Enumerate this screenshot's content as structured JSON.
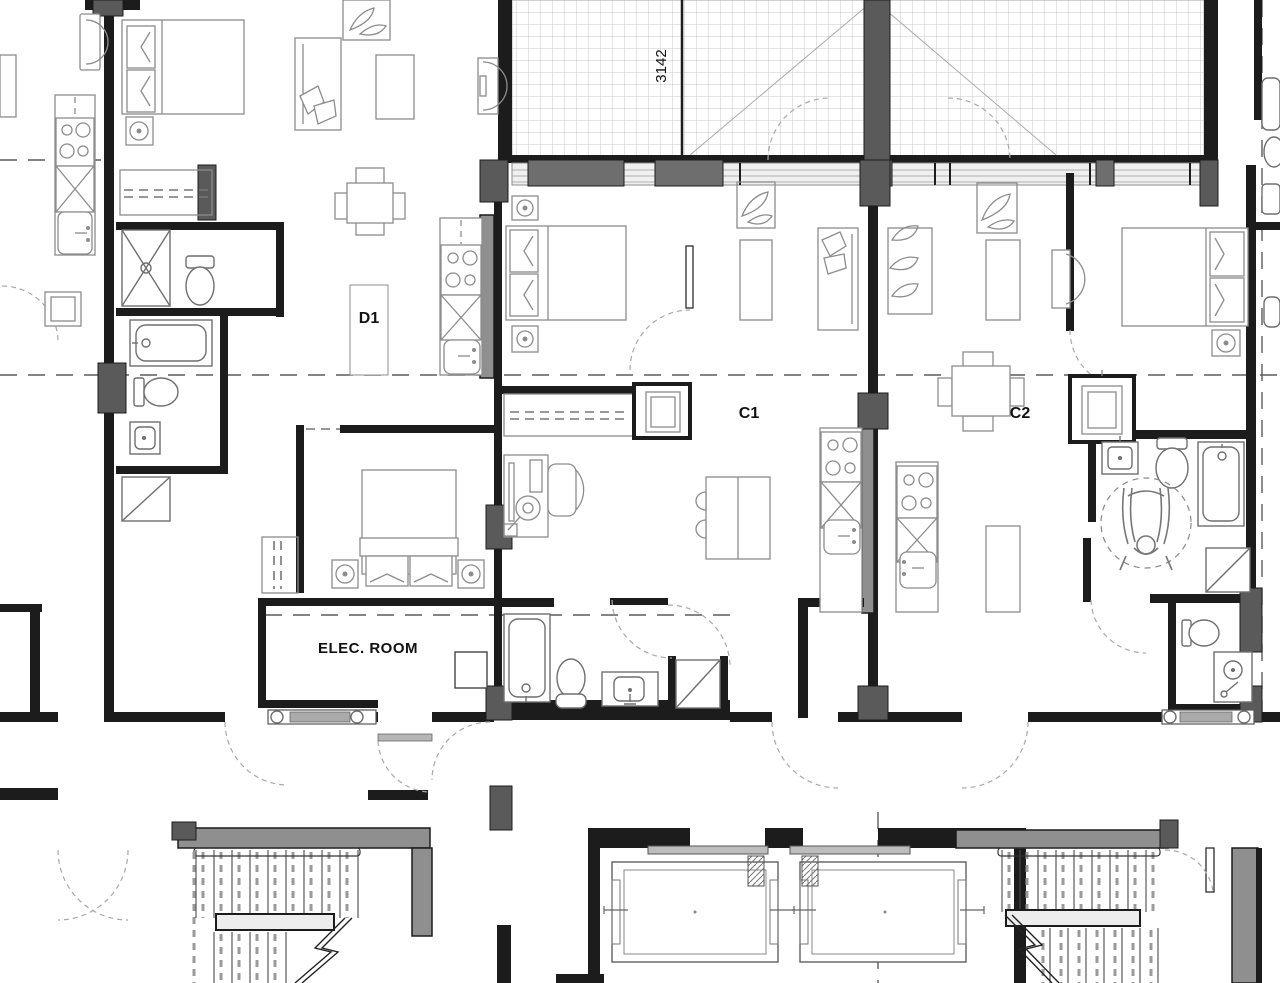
{
  "drawing": {
    "type": "architectural floor plan - residential units",
    "labels": {
      "dimension_3142": "3142",
      "unit_d1": "D1",
      "unit_c1": "C1",
      "unit_c2": "C2",
      "elec_room": "ELEC. ROOM"
    },
    "colors": {
      "wall": "#1c1c1c",
      "column": "#5a5a5a",
      "core_wall": "#8f8f8f",
      "fixture": "#8c8c8c",
      "deck_hatch": "#c9c9c9",
      "centerline": "#5c5c5c",
      "door_swing": "#a8a8a8",
      "background": "#ffffff"
    },
    "symbols": [
      "double-bed",
      "pillow",
      "nightstand-lamp",
      "toilet",
      "bathtub",
      "shower",
      "kitchen-range",
      "kitchen-sink",
      "dishwasher",
      "washer-dryer",
      "wheelchair-turning-circle",
      "stair-flight",
      "elevator-cab",
      "sofa",
      "plant",
      "dining-table",
      "coffee-table",
      "desk-chair",
      "closet-rod",
      "baseboard-heater",
      "door-swing",
      "balcony-tile-hatch"
    ]
  }
}
